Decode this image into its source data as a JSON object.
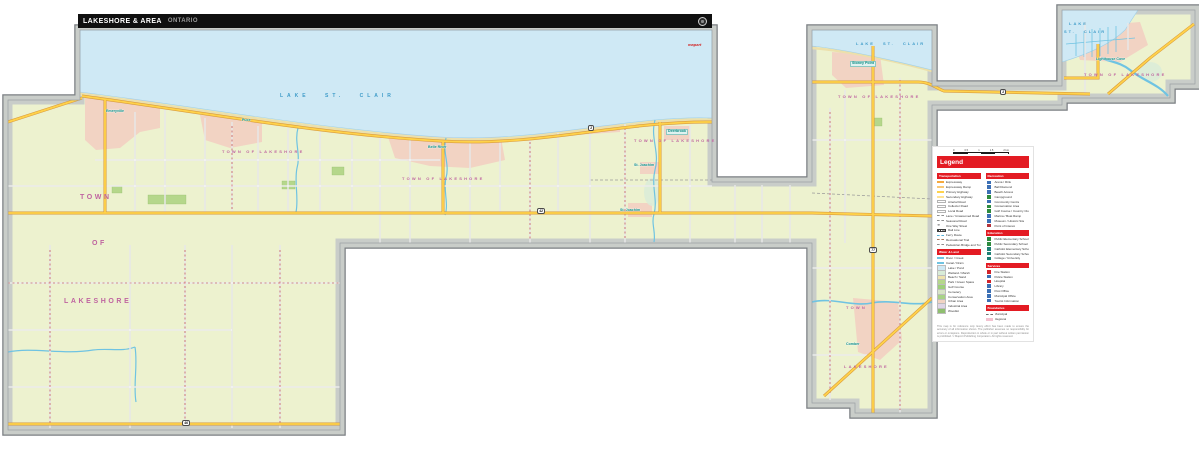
{
  "header": {
    "title": "LAKESHORE & AREA",
    "region": "ONTARIO"
  },
  "colors": {
    "accent_red": "#e31b23",
    "titlebar_black": "#101010",
    "land": "#edf2cf",
    "water": "#cfe9f5",
    "urban": "#f2d3c3",
    "park": "#b5d78b",
    "road_major": "#ffd24a",
    "road_major_casing": "#d89a3e",
    "municipality_label": "#bf64a0",
    "town_label": "#0d8c83",
    "lake_label": "#3f9cc9",
    "frame_gray": "#c9cdc9"
  },
  "legend": {
    "title": "Legend",
    "scale": {
      "ticks": [
        "0",
        "0.5",
        "1",
        "1.5",
        "2 km"
      ]
    },
    "columns": [
      {
        "sections": [
          {
            "header": "Transportation",
            "items": [
              {
                "label": "Expressway",
                "kind": "line",
                "color": "#f5a93c"
              },
              {
                "label": "Expressway Ramp",
                "kind": "line",
                "color": "#f8c977"
              },
              {
                "label": "Primary Highway",
                "kind": "line",
                "color": "#ffd24a"
              },
              {
                "label": "Secondary Highway",
                "kind": "line",
                "color": "#ffe394"
              },
              {
                "label": "Arterial Road",
                "kind": "line-outline"
              },
              {
                "label": "Collector Road",
                "kind": "line-outline"
              },
              {
                "label": "Local Road",
                "kind": "line-outline"
              },
              {
                "label": "Lane / Unassumed Road",
                "kind": "dash-gray"
              },
              {
                "label": "Seasonal Road",
                "kind": "dash-gray"
              },
              {
                "label": "One Way Street",
                "kind": "arrow"
              },
              {
                "label": "Rail Line",
                "kind": "rail"
              },
              {
                "label": "Ferry Route",
                "kind": "dash-blue"
              },
              {
                "label": "Recreational Trail",
                "kind": "dash-brown"
              },
              {
                "label": "Pedestrian Bridge and Tunnel",
                "kind": "dash-gray"
              }
            ]
          },
          {
            "header": "Water & Land",
            "items": [
              {
                "label": "River / Creek",
                "kind": "line",
                "color": "#6fc3e2"
              },
              {
                "label": "Canal / Drain",
                "kind": "line",
                "color": "#6fc3e2"
              },
              {
                "label": "Lake / Pond",
                "kind": "fill",
                "color": "#cfe9f5"
              },
              {
                "label": "Wetland / Marsh",
                "kind": "fill",
                "color": "#d9ecd8"
              },
              {
                "label": "Beach / Sand",
                "kind": "fill",
                "color": "#efe3ae"
              },
              {
                "label": "Park / Green Space",
                "kind": "fill",
                "color": "#b5d78b"
              },
              {
                "label": "Golf Course",
                "kind": "fill",
                "color": "#9ecf7a"
              },
              {
                "label": "Cemetery",
                "kind": "fill",
                "color": "#d7e4c6"
              },
              {
                "label": "Conservation Area",
                "kind": "fill",
                "color": "#a8d287"
              },
              {
                "label": "Urban Area",
                "kind": "fill",
                "color": "#f2d3c3"
              },
              {
                "label": "Industrial Area",
                "kind": "fill",
                "color": "#ded5e6"
              },
              {
                "label": "Woodlot",
                "kind": "fill",
                "color": "#8fbf6f"
              }
            ]
          }
        ]
      },
      {
        "sections": [
          {
            "header": "Recreation",
            "items": [
              {
                "label": "Arena / Rink",
                "kind": "sym",
                "color": "#3b6fb5"
              },
              {
                "label": "Ball Diamond",
                "kind": "sym",
                "color": "#3b6fb5"
              },
              {
                "label": "Beach Access",
                "kind": "sym",
                "color": "#3b6fb5"
              },
              {
                "label": "Campground",
                "kind": "sym",
                "color": "#2e8b3e"
              },
              {
                "label": "Community Centre",
                "kind": "sym",
                "color": "#3b6fb5"
              },
              {
                "label": "Conservation Area",
                "kind": "sym",
                "color": "#2e8b3e"
              },
              {
                "label": "Golf Course / Country Club",
                "kind": "sym",
                "color": "#2e8b3e"
              },
              {
                "label": "Marina / Boat Ramp",
                "kind": "sym",
                "color": "#3b6fb5"
              },
              {
                "label": "Museum / Historic Site",
                "kind": "sym",
                "color": "#3b6fb5"
              },
              {
                "label": "Point of Interest",
                "kind": "sym",
                "color": "#b5333b"
              }
            ]
          },
          {
            "header": "Education",
            "items": [
              {
                "label": "Public Elementary School",
                "kind": "sym",
                "color": "#2e8b3e"
              },
              {
                "label": "Public Secondary School",
                "kind": "sym",
                "color": "#2e8b3e"
              },
              {
                "label": "Catholic Elementary School",
                "kind": "sym",
                "color": "#1f7f74"
              },
              {
                "label": "Catholic Secondary School",
                "kind": "sym",
                "color": "#1f7f74"
              },
              {
                "label": "College / University",
                "kind": "sym",
                "color": "#1f7f74"
              }
            ]
          },
          {
            "header": "Services",
            "items": [
              {
                "label": "Fire Station",
                "kind": "sym",
                "color": "#d2232a"
              },
              {
                "label": "Police Station",
                "kind": "sym",
                "color": "#3b6fb5"
              },
              {
                "label": "Hospital",
                "kind": "sym",
                "color": "#d2232a"
              },
              {
                "label": "Library",
                "kind": "sym",
                "color": "#3b6fb5"
              },
              {
                "label": "Post Office",
                "kind": "sym",
                "color": "#3b6fb5"
              },
              {
                "label": "Municipal Office",
                "kind": "sym",
                "color": "#3b6fb5"
              },
              {
                "label": "Tourist Information",
                "kind": "sym",
                "color": "#3b6fb5"
              }
            ]
          },
          {
            "header": "Boundaries",
            "items": [
              {
                "label": "Municipal",
                "kind": "bound-gray"
              },
              {
                "label": "Regional",
                "kind": "bound-pink"
              }
            ]
          }
        ]
      }
    ],
    "footnote": "This map is for reference only. Every effort has been made to ensure the accuracy of all information shown. The publisher assumes no responsibility for errors or omissions. Reproduction in whole or in part without written permission is prohibited. © MapArt Publishing Corporation. All rights reserved."
  },
  "map": {
    "labels": [
      {
        "text": "LAKE   ST.   CLAIR",
        "x": 280,
        "y": 94,
        "cls": "lake-lg",
        "name": "lake-st-clair-label"
      },
      {
        "text": "LAKE  ST.  CLAIR",
        "x": 856,
        "y": 42,
        "cls": "lake-sm",
        "name": "lake-st-clair-label"
      },
      {
        "text": "LAKE",
        "x": 1069,
        "y": 22,
        "cls": "lake-sm",
        "name": "lake-st-clair-label"
      },
      {
        "text": "ST. CLAIR",
        "x": 1064,
        "y": 30,
        "cls": "lake-sm",
        "name": "lake-st-clair-label"
      },
      {
        "text": "TOWN  OF  LAKESHORE",
        "x": 222,
        "y": 150,
        "cls": "muni",
        "name": "municipality-label"
      },
      {
        "text": "TOWN  OF  LAKESHORE",
        "x": 402,
        "y": 177,
        "cls": "muni",
        "name": "municipality-label"
      },
      {
        "text": "TOWN  OF  LAKESHORE",
        "x": 634,
        "y": 139,
        "cls": "muni",
        "name": "municipality-label"
      },
      {
        "text": "TOWN  OF  LAKESHORE",
        "x": 838,
        "y": 95,
        "cls": "muni",
        "name": "municipality-label"
      },
      {
        "text": "TOWN  OF  LAKESHORE",
        "x": 1084,
        "y": 73,
        "cls": "muni",
        "name": "municipality-label"
      },
      {
        "text": "TOWN",
        "x": 846,
        "y": 306,
        "cls": "muni",
        "name": "municipality-label"
      },
      {
        "text": "LAKESHORE",
        "x": 844,
        "y": 365,
        "cls": "muni",
        "name": "municipality-label"
      },
      {
        "text": "TOWN",
        "x": 80,
        "y": 194,
        "cls": "muni-big",
        "name": "municipality-label"
      },
      {
        "text": "OF",
        "x": 92,
        "y": 240,
        "cls": "muni-big",
        "name": "municipality-label"
      },
      {
        "text": "LAKESHORE",
        "x": 64,
        "y": 298,
        "cls": "muni-big",
        "name": "municipality-label"
      },
      {
        "text": "Belle River",
        "x": 428,
        "y": 146,
        "cls": "town",
        "name": "town-label"
      },
      {
        "text": "Emeryville",
        "x": 106,
        "y": 110,
        "cls": "town",
        "name": "town-label"
      },
      {
        "text": "Puce",
        "x": 242,
        "y": 119,
        "cls": "town",
        "name": "town-label"
      },
      {
        "text": "Deerbrook",
        "x": 666,
        "y": 129,
        "cls": "town-box",
        "name": "town-label"
      },
      {
        "text": "St. Joachim",
        "x": 634,
        "y": 164,
        "cls": "town",
        "name": "town-label"
      },
      {
        "text": "St. Joachim",
        "x": 620,
        "y": 209,
        "cls": "town",
        "name": "town-label"
      },
      {
        "text": "Stoney Point",
        "x": 850,
        "y": 61,
        "cls": "town-box",
        "name": "town-label"
      },
      {
        "text": "Comber",
        "x": 846,
        "y": 343,
        "cls": "town",
        "name": "town-label"
      },
      {
        "text": "Lighthouse Cove",
        "x": 1096,
        "y": 58,
        "cls": "town",
        "name": "town-label"
      },
      {
        "text": "mapart",
        "x": 688,
        "y": 43,
        "cls": "brand",
        "name": "brand-label"
      }
    ],
    "shields": [
      {
        "num": "2",
        "x": 588,
        "y": 125
      },
      {
        "num": "42",
        "x": 537,
        "y": 208
      },
      {
        "num": "77",
        "x": 869,
        "y": 247
      },
      {
        "num": "46",
        "x": 182,
        "y": 420
      },
      {
        "num": "2",
        "x": 1000,
        "y": 89
      }
    ]
  }
}
